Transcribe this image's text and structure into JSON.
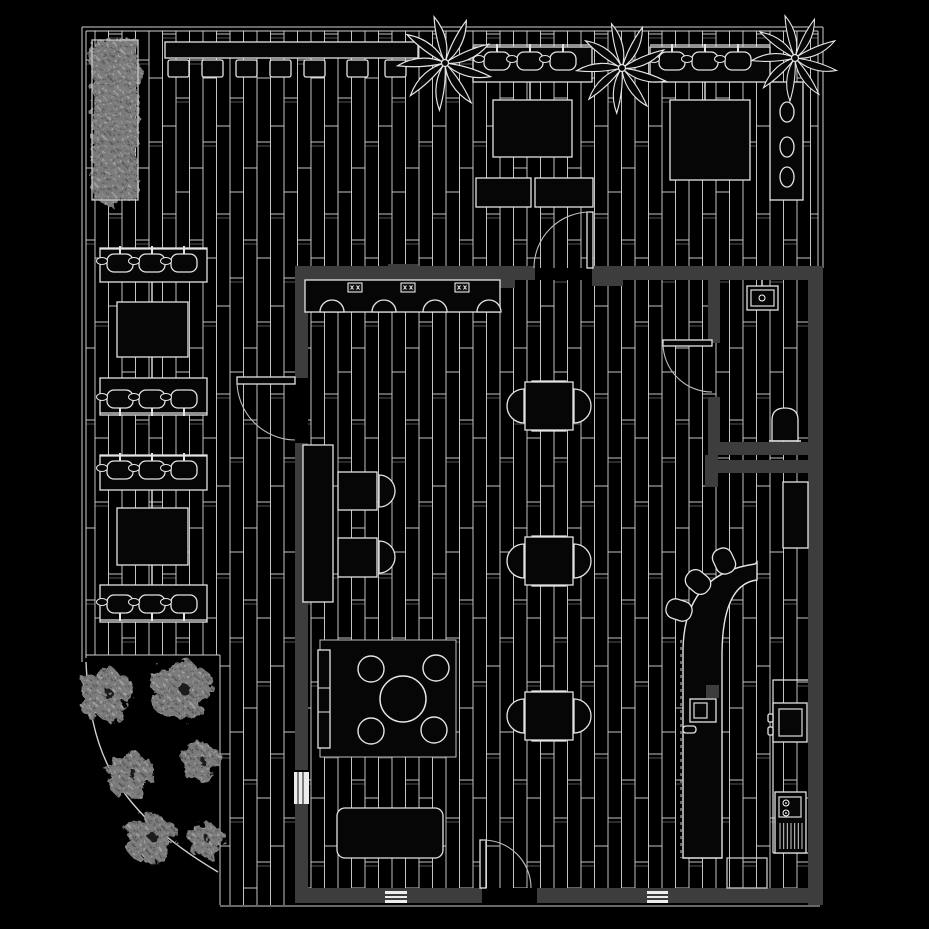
{
  "plan": {
    "canvas": {
      "w": 929,
      "h": 929
    },
    "palette": {
      "background": "#000000",
      "plank_line": "#d8d8d8",
      "outline": "#e4e4e4",
      "furniture_fill": "#060606",
      "wall_fill": "#3d3d3d",
      "foliage_gray": "#7a7a7a",
      "glass_white": "#ededed"
    },
    "floors": [
      {
        "x": 86,
        "y": 31,
        "w": 732,
        "h": 237
      },
      {
        "x": 86,
        "y": 268,
        "w": 209,
        "h": 387
      },
      {
        "x": 220,
        "y": 655,
        "w": 75,
        "h": 250
      },
      {
        "x": 308,
        "y": 280,
        "w": 500,
        "h": 608
      }
    ],
    "boundary_lines": [
      [
        82,
        27,
        823,
        27
      ],
      [
        86,
        31,
        818,
        31
      ],
      [
        82,
        27,
        82,
        662
      ],
      [
        86,
        31,
        86,
        658
      ],
      [
        818,
        31,
        818,
        268
      ],
      [
        823,
        27,
        823,
        268
      ],
      [
        220,
        906,
        820,
        906
      ]
    ],
    "garden": {
      "top_line": [
        86,
        655,
        220,
        655
      ],
      "right_line": [
        220,
        655,
        220,
        905
      ],
      "curve": "M 86 662 C 90 748 110 808 218 872"
    },
    "walls": [
      [
        295,
        266,
        240,
        14
      ],
      [
        592,
        266,
        116,
        14
      ],
      [
        708,
        266,
        115,
        14
      ],
      [
        808,
        266,
        15,
        639
      ],
      [
        295,
        280,
        13,
        98
      ],
      [
        295,
        443,
        13,
        327
      ],
      [
        295,
        804,
        13,
        99
      ],
      [
        295,
        888,
        187,
        15
      ],
      [
        537,
        888,
        271,
        15
      ],
      [
        708,
        280,
        12,
        63
      ],
      [
        708,
        397,
        12,
        45
      ],
      [
        708,
        442,
        100,
        13
      ],
      [
        705,
        455,
        13,
        32
      ],
      [
        718,
        460,
        90,
        13
      ],
      [
        388,
        264,
        30,
        22
      ],
      [
        592,
        266,
        31,
        20
      ],
      [
        500,
        266,
        15,
        22
      ]
    ],
    "window": {
      "x": 294,
      "y": 772,
      "w": 15,
      "h": 32,
      "mullions": [
        298,
        303
      ]
    },
    "vents": [
      [
        385,
        891,
        22,
        12
      ],
      [
        647,
        891,
        21,
        12
      ]
    ],
    "benches": [
      [
        165,
        42,
        253,
        16
      ],
      [
        473,
        47,
        119,
        35
      ],
      [
        650,
        47,
        120,
        35
      ],
      [
        100,
        248,
        107,
        34
      ],
      [
        100,
        378,
        107,
        37
      ],
      [
        100,
        455,
        107,
        35
      ],
      [
        100,
        585,
        107,
        37
      ],
      [
        303,
        445,
        30,
        157
      ]
    ],
    "right_bench": {
      "rect": [
        770,
        82,
        33,
        118
      ],
      "stools": [
        [
          787,
          112
        ],
        [
          787,
          147
        ],
        [
          787,
          177
        ]
      ]
    },
    "cushions": {
      "y": 60,
      "w": 21,
      "h": 17,
      "xs": [
        168,
        202,
        236,
        270,
        304,
        347,
        385
      ]
    },
    "dark_tables": [
      [
        493,
        100,
        79,
        57
      ],
      [
        670,
        100,
        80,
        80
      ],
      [
        476,
        178,
        55,
        29
      ],
      [
        535,
        178,
        58,
        29
      ],
      [
        117,
        302,
        71,
        55
      ],
      [
        117,
        508,
        71,
        57
      ]
    ],
    "stool_groups": [
      {
        "rail": [
          473,
          45,
          592,
          45
        ],
        "stools": [
          [
            497,
            61
          ],
          [
            530,
            61
          ],
          [
            563,
            61
          ]
        ],
        "stem": "up"
      },
      {
        "rail": [
          650,
          45,
          770,
          45
        ],
        "stools": [
          [
            672,
            61
          ],
          [
            705,
            61
          ],
          [
            738,
            61
          ]
        ],
        "stem": "up"
      },
      {
        "rail": [
          100,
          249,
          207,
          249
        ],
        "stools": [
          [
            120,
            263
          ],
          [
            152,
            263
          ],
          [
            184,
            263
          ]
        ],
        "stem": "up"
      },
      {
        "rail": [
          100,
          413,
          207,
          413
        ],
        "stools": [
          [
            120,
            399
          ],
          [
            152,
            399
          ],
          [
            184,
            399
          ]
        ],
        "stem": "down"
      },
      {
        "rail": [
          100,
          456,
          207,
          456
        ],
        "stools": [
          [
            120,
            470
          ],
          [
            152,
            470
          ],
          [
            184,
            470
          ]
        ],
        "stem": "up"
      },
      {
        "rail": [
          100,
          620,
          207,
          620
        ],
        "stools": [
          [
            120,
            604
          ],
          [
            152,
            604
          ],
          [
            184,
            604
          ]
        ],
        "stem": "down"
      }
    ],
    "connectors": [
      [
        530,
        82,
        530,
        100
      ],
      [
        705,
        82,
        705,
        100
      ],
      [
        152,
        282,
        152,
        302
      ],
      [
        152,
        357,
        152,
        378
      ],
      [
        152,
        490,
        152,
        508
      ],
      [
        152,
        565,
        152,
        585
      ]
    ],
    "dining": {
      "table_size": 48,
      "chair_r": 17,
      "centers": [
        [
          549,
          406
        ],
        [
          549,
          561
        ],
        [
          549,
          716
        ]
      ]
    },
    "mid_tables": {
      "rects": [
        [
          338,
          472,
          39,
          38
        ],
        [
          338,
          538,
          39,
          39
        ]
      ],
      "chairs": [
        [
          379,
          491
        ],
        [
          379,
          557
        ]
      ],
      "chair_r": 16
    },
    "counter": {
      "rect": [
        305,
        280,
        195,
        32
      ],
      "marks": [
        [
          348,
          283
        ],
        [
          401,
          283
        ],
        [
          455,
          283
        ]
      ],
      "stool_y": 312,
      "stools_cx": [
        332,
        384,
        435,
        489
      ]
    },
    "bar": {
      "body": "M 683 858 L 683 650 Q 684 574 755 564 L 757 562 L 757 580 Q 723 584 722 652 L 722 858 Z",
      "dash_edge": [
        681,
        640,
        681,
        858
      ],
      "stools": [
        [
          724,
          561,
          -25
        ],
        [
          698,
          582,
          -50
        ],
        [
          679,
          610,
          -72
        ]
      ]
    },
    "kitchen": {
      "upper_cabinet": [
        783,
        482,
        25,
        66
      ],
      "counter_outline": "M 773 853 L 773 680 L 808 680 M 773 853 L 808 853",
      "stove_outer": [
        773,
        703,
        34,
        39
      ],
      "stove_inner": [
        779,
        709,
        23,
        27
      ],
      "stove_knobs": [
        [
          768,
          714,
          5,
          8
        ],
        [
          768,
          727,
          5,
          8
        ]
      ],
      "sink_outer": [
        775,
        792,
        31,
        61
      ],
      "sink_box": [
        779,
        797,
        22,
        20
      ],
      "sink_taps": [
        [
          786,
          803
        ],
        [
          786,
          813
        ]
      ],
      "drain": {
        "x1": 780,
        "x2": 802,
        "y1": 823,
        "y2": 849,
        "n": 7
      },
      "appliance_outer": [
        690,
        699,
        26,
        23
      ],
      "appliance_inner": [
        694,
        703,
        13,
        15
      ],
      "appliance_block": [
        706,
        685,
        13,
        13
      ],
      "handle": [
        683,
        726,
        13,
        7
      ],
      "doormat": [
        727,
        858,
        40,
        30
      ]
    },
    "bath": {
      "sink_outer": [
        747,
        286,
        31,
        24
      ],
      "sink_inner": [
        751,
        290,
        23,
        16
      ],
      "faucet": [
        762,
        298
      ],
      "stem": [
        762,
        280,
        762,
        286
      ],
      "toilet": "M 772 441 L 772 420 Q 772 408 785 408 Q 798 408 798 420 L 798 441 Z",
      "toilet_base": [
        769,
        441,
        801,
        441
      ]
    },
    "lounge": {
      "rug": [
        320,
        640,
        136,
        117
      ],
      "table": [
        403,
        699,
        23
      ],
      "stools": [
        [
          371,
          669,
          13
        ],
        [
          436,
          668,
          13
        ],
        [
          371,
          731,
          13
        ],
        [
          434,
          730,
          13
        ]
      ],
      "console": [
        318,
        650,
        12,
        98
      ],
      "console_dividers": [
        688,
        712
      ]
    },
    "sofa": {
      "rect": [
        337,
        808,
        106,
        50
      ],
      "backs": [
        363,
        407
      ],
      "back_y": 809,
      "back_r": 16
    },
    "doors": [
      {
        "leaf": [
          237,
          377,
          58,
          7
        ],
        "arc": "M 237 381 A 59 59 0 0 0 295 440"
      },
      {
        "leaf": [
          587,
          212,
          6,
          56
        ],
        "arc": "M 590 212 A 56 56 0 0 0 534 268"
      },
      {
        "leaf": [
          663,
          340,
          49,
          6
        ],
        "arc": "M 663 343 A 49 49 0 0 0 712 392"
      },
      {
        "leaf": [
          480,
          840,
          6,
          48
        ],
        "arc": "M 483 840 A 48 48 0 0 1 531 888"
      }
    ],
    "palms": [
      [
        445,
        63,
        46
      ],
      [
        622,
        68,
        44
      ],
      [
        795,
        58,
        42
      ]
    ],
    "hedge": [
      92,
      40,
      46,
      160
    ],
    "trees": [
      [
        105,
        695,
        30
      ],
      [
        180,
        690,
        34
      ],
      [
        130,
        775,
        26
      ],
      [
        200,
        762,
        22
      ],
      [
        150,
        838,
        28
      ],
      [
        205,
        840,
        20
      ]
    ]
  }
}
